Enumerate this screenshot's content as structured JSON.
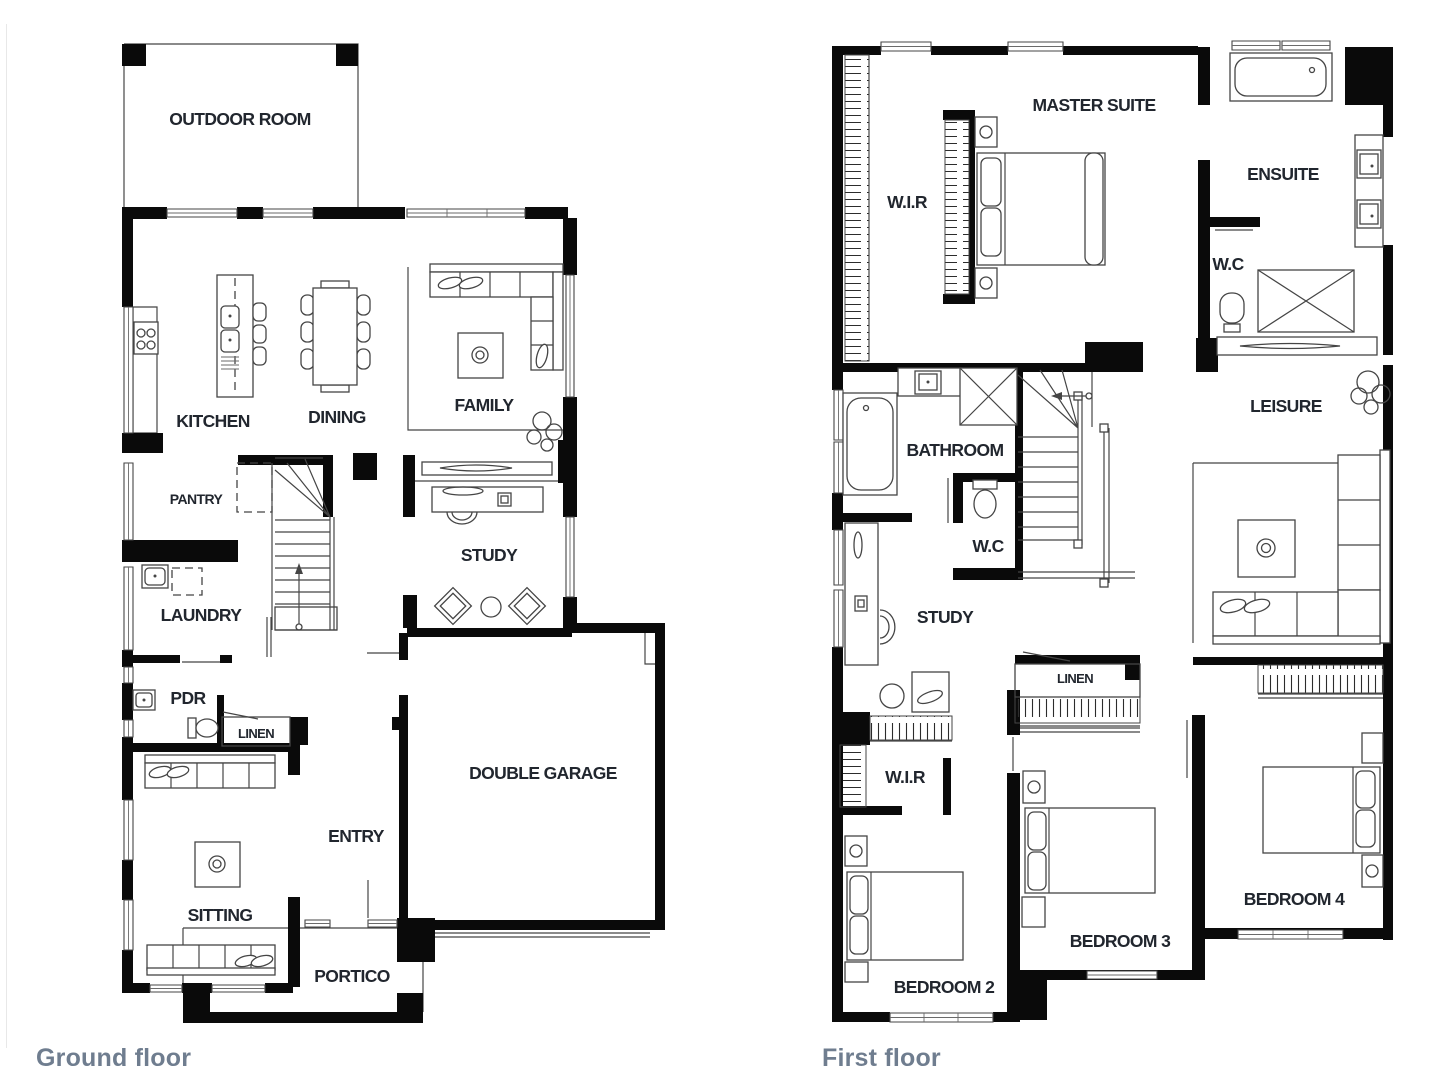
{
  "colors": {
    "background": "#ffffff",
    "wall": "#0a0a0a",
    "line": "#454545",
    "label": "#21262e",
    "caption": "#6f7d8f"
  },
  "ground_floor": {
    "caption": "Ground floor",
    "rooms": [
      {
        "id": "outdoor-room",
        "label": "OUTDOOR ROOM"
      },
      {
        "id": "kitchen",
        "label": "KITCHEN"
      },
      {
        "id": "dining",
        "label": "DINING"
      },
      {
        "id": "family",
        "label": "FAMILY"
      },
      {
        "id": "pantry",
        "label": "PANTRY"
      },
      {
        "id": "study",
        "label": "STUDY"
      },
      {
        "id": "laundry",
        "label": "LAUNDRY"
      },
      {
        "id": "pdr",
        "label": "PDR"
      },
      {
        "id": "linen",
        "label": "LINEN"
      },
      {
        "id": "double-garage",
        "label": "DOUBLE GARAGE"
      },
      {
        "id": "entry",
        "label": "ENTRY"
      },
      {
        "id": "sitting",
        "label": "SITTING"
      },
      {
        "id": "portico",
        "label": "PORTICO"
      }
    ]
  },
  "first_floor": {
    "caption": "First floor",
    "rooms": [
      {
        "id": "master-suite",
        "label": "MASTER SUITE"
      },
      {
        "id": "wir-master",
        "label": "W.I.R"
      },
      {
        "id": "ensuite",
        "label": "ENSUITE"
      },
      {
        "id": "wc-ensuite",
        "label": "W.C"
      },
      {
        "id": "bathroom",
        "label": "BATHROOM"
      },
      {
        "id": "leisure",
        "label": "LEISURE"
      },
      {
        "id": "wc-hall",
        "label": "W.C"
      },
      {
        "id": "study",
        "label": "STUDY"
      },
      {
        "id": "linen",
        "label": "LINEN"
      },
      {
        "id": "wir-bed2",
        "label": "W.I.R"
      },
      {
        "id": "bedroom-2",
        "label": "BEDROOM 2"
      },
      {
        "id": "bedroom-3",
        "label": "BEDROOM 3"
      },
      {
        "id": "bedroom-4",
        "label": "BEDROOM 4"
      }
    ]
  }
}
